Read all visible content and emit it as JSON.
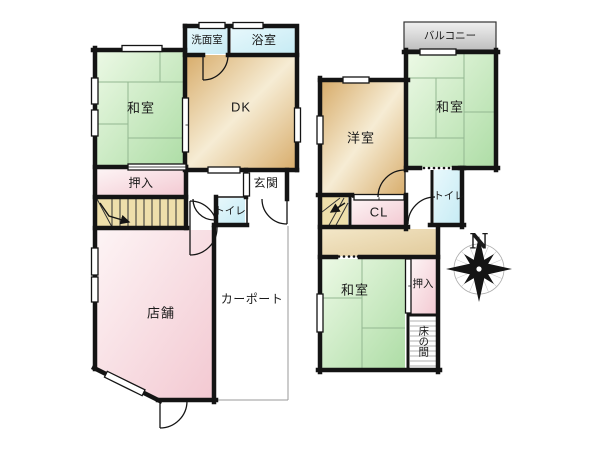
{
  "first_floor": {
    "washroom": "洗面室",
    "bathroom": "浴室",
    "japanese_room": "和室",
    "dining_kitchen": "DK",
    "closet": "押入",
    "entrance": "玄関",
    "toilet": "トイレ",
    "shop": "店舗",
    "carport": "カーポート"
  },
  "second_floor": {
    "balcony": "バルコニー",
    "japanese_room_north": "和室",
    "western_room": "洋室",
    "toilet": "トイレ",
    "closet": "CL",
    "futon_closet": "押入",
    "tokonoma": "床の間"
  },
  "compass": {
    "north": "N"
  },
  "colors": {
    "wall": "#141414",
    "tatami_green_light": "#ecf9e5",
    "tatami_green": "#aedda6",
    "wood_tan_light": "#f6ecd4",
    "wood_tan": "#d8ad6c",
    "closet_pink_light": "#fdf4f5",
    "closet_pink": "#f3c9d2",
    "water_cyan": "#c6ebf4",
    "stairs_khaki": "#eedfab",
    "balcony_gray": "#bfbfbf",
    "carport_line_gray": "#9a9a9a"
  }
}
